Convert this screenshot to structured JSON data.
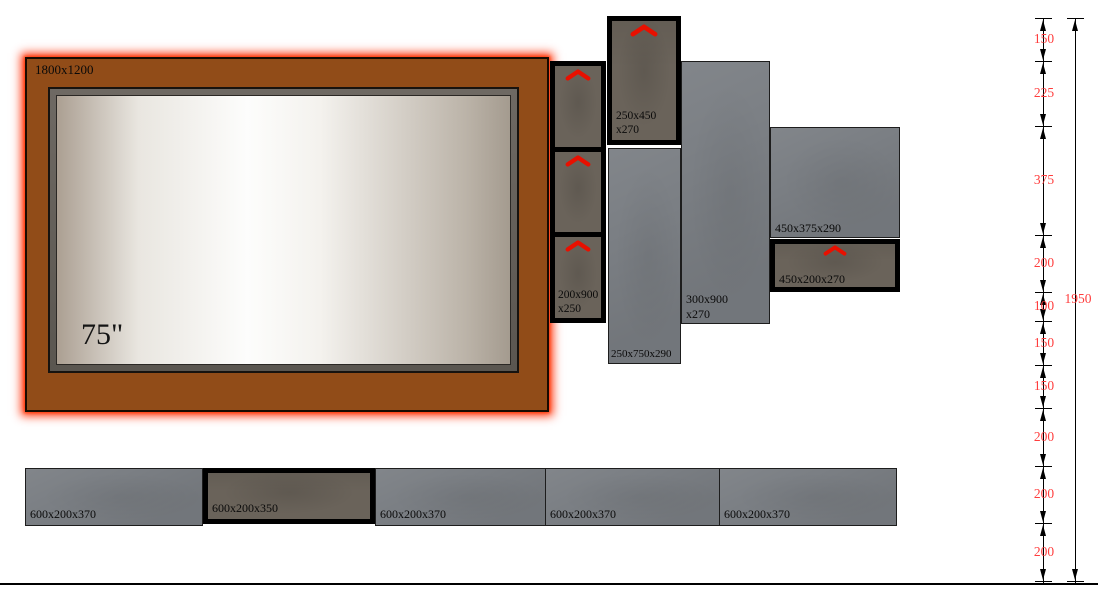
{
  "tv": {
    "panel_label": "1800x1200",
    "size_label": "75\""
  },
  "cabinets": {
    "tall_doors": {
      "line1": "200x900",
      "line2": "x250"
    },
    "upper_door": {
      "line1": "250x450",
      "line2": "x270"
    },
    "open_tall": {
      "label": "250x750x290"
    },
    "open_column": {
      "line1": "300x900",
      "line2": "x270"
    },
    "shelf_open": {
      "label": "450x375x290"
    },
    "shelf_door": {
      "label": "450x200x270"
    }
  },
  "bottom_row": [
    {
      "label": "600x200x370"
    },
    {
      "label": "600x200x350"
    },
    {
      "label": "600x200x370"
    },
    {
      "label": "600x200x370"
    },
    {
      "label": "600x200x370"
    }
  ],
  "ruler": {
    "segments": [
      "150",
      "225",
      "375",
      "200",
      "100",
      "150",
      "150",
      "200",
      "200",
      "200"
    ],
    "total": "1950"
  },
  "icons": {
    "door_swing": "chevron-up"
  },
  "colors": {
    "panel_orange": "#914c18",
    "glow_red": "#ff2b00",
    "cabinet_gray": "#7b7f84",
    "cabinet_dark": "#6a635a",
    "dimension_text": "#ff3d3d",
    "chevron_red": "#e81000"
  }
}
